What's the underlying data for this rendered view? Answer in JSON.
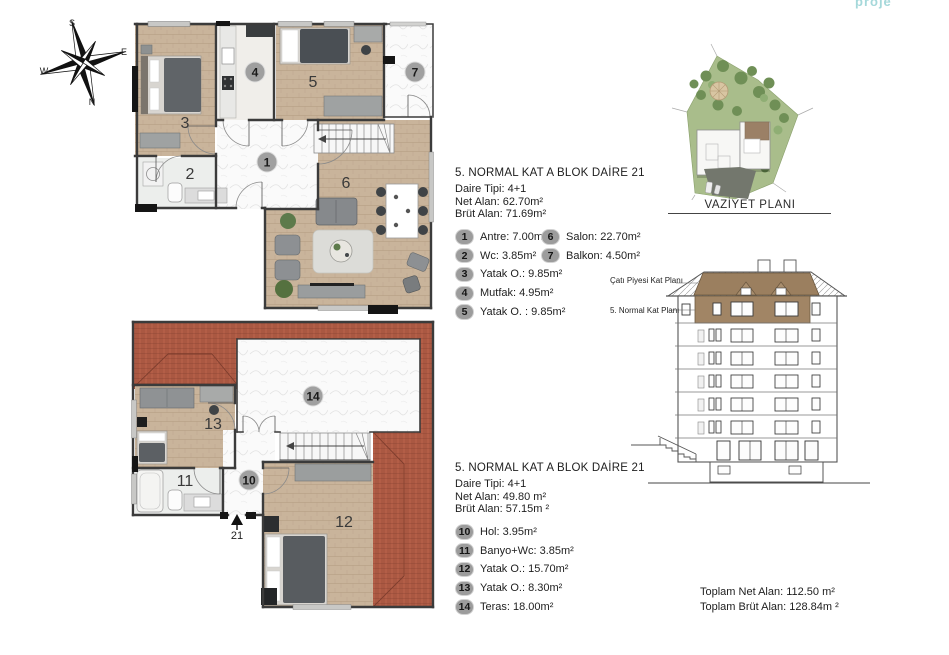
{
  "logo": {
    "text": "proje"
  },
  "compass": {
    "n": "N",
    "s": "S",
    "e": "E",
    "w": "W"
  },
  "unit_top": {
    "title": "5. NORMAL KAT A BLOK DAİRE 21",
    "type_line": "Daire Tipi: 4+1",
    "net_line": "Net Alan: 62.70m²",
    "brut_line": "Brüt Alan: 71.69m²",
    "legend": [
      {
        "no": "1",
        "label": "Antre: 7.00m²"
      },
      {
        "no": "2",
        "label": "Wc: 3.85m²"
      },
      {
        "no": "3",
        "label": "Yatak O.: 9.85m²"
      },
      {
        "no": "4",
        "label": "Mutfak: 4.95m²"
      },
      {
        "no": "5",
        "label": "Yatak O. : 9.85m²"
      },
      {
        "no": "6",
        "label": "Salon: 22.70m²"
      },
      {
        "no": "7",
        "label": "Balkon: 4.50m²"
      }
    ]
  },
  "unit_roof": {
    "title": "5. NORMAL KAT A BLOK DAİRE 21",
    "type_line": "Daire Tipi: 4+1",
    "net_line": "Net Alan: 49.80 m²",
    "brut_line": "Brüt Alan: 57.15m ²",
    "legend": [
      {
        "no": "10",
        "label": "Hol: 3.95m²"
      },
      {
        "no": "11",
        "label": "Banyo+Wc: 3.85m²"
      },
      {
        "no": "12",
        "label": "Yatak O.: 15.70m²"
      },
      {
        "no": "13",
        "label": "Yatak O.: 8.30m²"
      },
      {
        "no": "14",
        "label": "Teras: 18.00m²"
      }
    ],
    "entry_label": "21"
  },
  "site_plan": {
    "label": "VAZİYET PLANI"
  },
  "elevation": {
    "label_cati": "Çatı Piyesi Kat Planı",
    "label_normal": "5. Normal Kat Planı"
  },
  "totals": {
    "net": "Toplam Net Alan: 112.50 m²",
    "brut": "Toplam Brüt Alan: 128.84m ²"
  },
  "colors": {
    "wood": "#c9b49b",
    "marble": "#fafafa",
    "tile": "#b35e47",
    "wall": "#3b3b3b",
    "siteGreen": "#a9bd8b",
    "treeGreen": "#6f8f56",
    "elevBrown": "#a18565",
    "badgeGray": "#9c9c9c",
    "logoTeal": "#a5d8da"
  }
}
